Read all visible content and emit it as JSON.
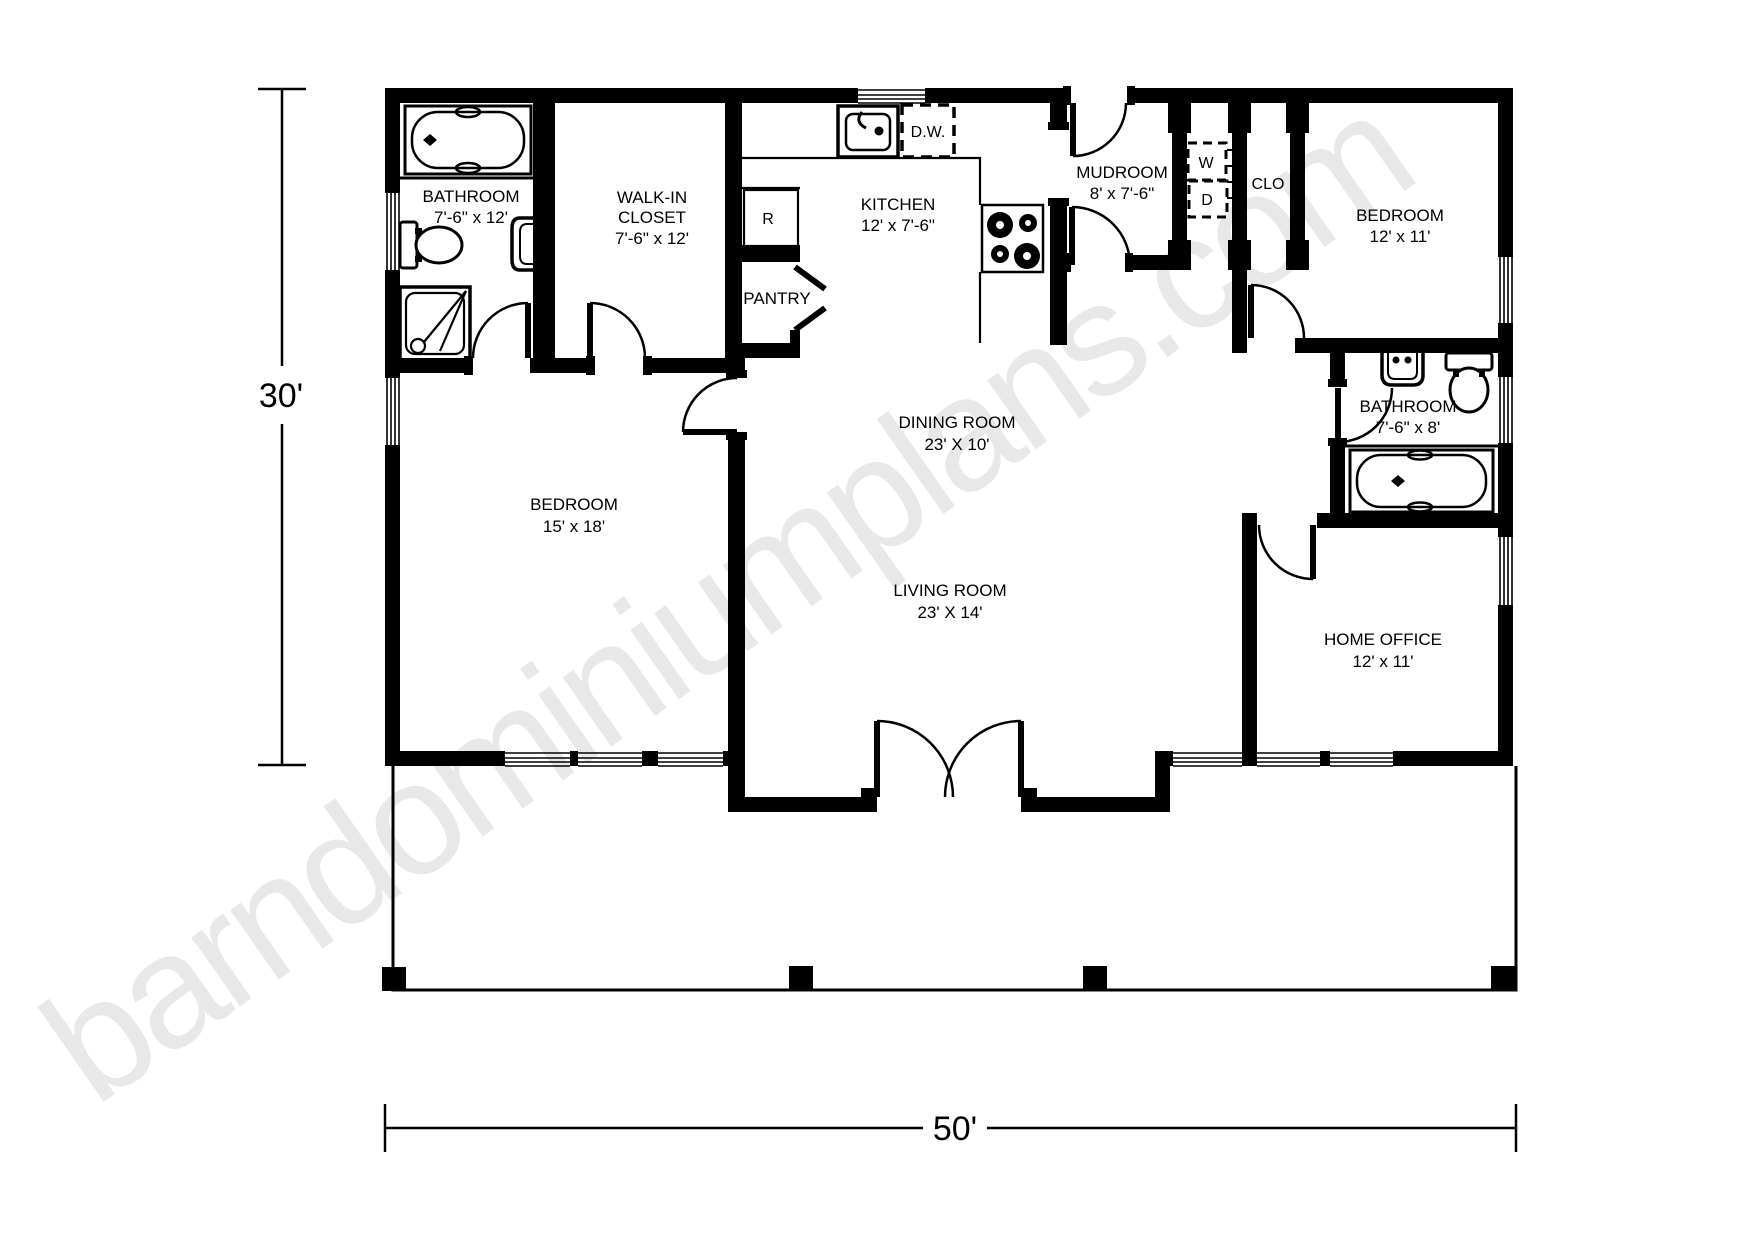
{
  "watermark": "barndominiumplans.com",
  "dimensions": {
    "height_label": "30'",
    "width_label": "50'"
  },
  "rooms": {
    "bathroom1": {
      "name": "BATHROOM",
      "dims": "7'-6\" x 12'"
    },
    "walkin": {
      "name": "WALK-IN",
      "name2": "CLOSET",
      "dims": "7'-6\" x 12'"
    },
    "kitchen": {
      "name": "KITCHEN",
      "dims": "12' x 7'-6\""
    },
    "pantry": {
      "name": "PANTRY"
    },
    "mudroom": {
      "name": "MUDROOM",
      "dims": "8' x 7'-6\""
    },
    "bedroom2": {
      "name": "BEDROOM",
      "dims": "12' x 11'"
    },
    "bathroom2": {
      "name": "BATHROOM",
      "dims": "7'-6\" x 8'"
    },
    "dining": {
      "name": "DINING ROOM",
      "dims": "23' X 10'"
    },
    "living": {
      "name": "LIVING ROOM",
      "dims": "23' X 14'"
    },
    "bedroom1": {
      "name": "BEDROOM",
      "dims": "15' x 18'"
    },
    "office": {
      "name": "HOME OFFICE",
      "dims": "12' x 11'"
    }
  },
  "appliances": {
    "dishwasher": "D.W.",
    "refrigerator": "R",
    "washer": "W",
    "dryer": "D",
    "closet": "CLO"
  },
  "colors": {
    "wall": "#000000",
    "watermark": "#e8e8e8",
    "background": "#ffffff"
  }
}
